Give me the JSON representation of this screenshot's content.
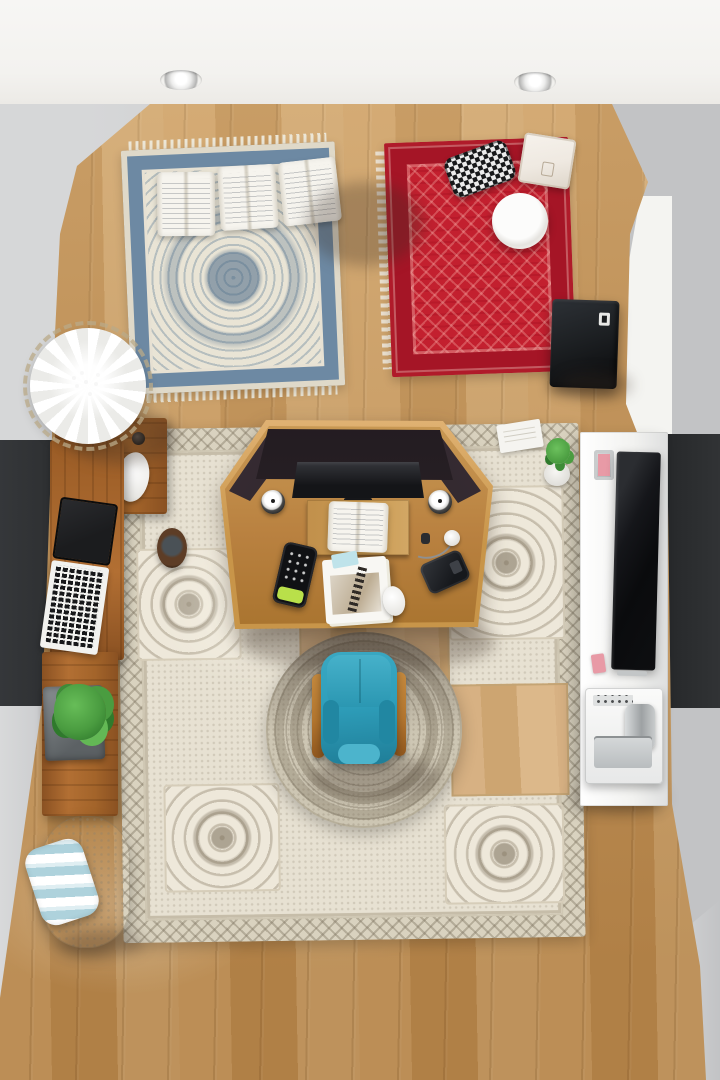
{
  "scene": {
    "view": "top-down",
    "setting": "home office room"
  },
  "palette": {
    "ceiling": "#f3f2ef",
    "wall_light": "#d6d7d8",
    "wall_mid": "#c2c3c5",
    "wall_white": "#f4f4f1",
    "wall_dark": "#2e3032",
    "wall_dark2": "#26282a",
    "floor_a": "#cb9d63",
    "floor_b": "#bd8c50",
    "rug_blue_field": "#e9e4d5",
    "rug_blue_border": "#6d89a3",
    "rug_red": "#c3202f",
    "rug_red_dark": "#a51526",
    "rug_beige": "#d9d2bf",
    "rug_beige_field": "#e7e1d2",
    "rug_round": "#cdc6b3",
    "wood_a": "#b26f33",
    "wood_b": "#8a5122",
    "desk_wood": "#b98140",
    "desk_rim": "#e0b273",
    "desk_panel": "#2c2329",
    "monitor": "#141518",
    "platform": "#c9994f",
    "page_white": "#f6f4ee",
    "chair_teal": "#2f9fbb",
    "chair_teal_dark": "#1f7e98",
    "chair_arm": "#b5772f",
    "pouf": "#d9d2c1",
    "pillow_stripe": "#aed2dc",
    "plant_green": "#4a9c40",
    "plant_green_dark": "#2f7a2c",
    "laptop_screen": "#1b1c1e",
    "laptop_deck": "#f2f2ef",
    "cube_black": "#1d2023",
    "tv_black": "#0e0f11",
    "cabinet_white": "#f2f2f0",
    "printer_silver": "#b9bdbf",
    "pink_note": "#e89aa6",
    "lamp_shade": "#b7bdb8",
    "brass": "#8c6a33",
    "umbrella_white": "#f7f6f2",
    "disc_white": "#f3f2ee",
    "box_white": "#efe9e1",
    "shadow": "rgba(60,48,38,0.30)"
  },
  "objects": {
    "room": "Top-down view of a compact home office",
    "ceiling": "White ceiling band",
    "recessed_light": "Recessed ceiling light",
    "wood_floor": "Light oak plank floor",
    "pendant_lamp": "Pendant ceiling lamp with sage shade and brass core",
    "blue_rug": "Blue-and-ivory oriental rug",
    "open_books": "Three open books on rug",
    "red_rug": "Red patterned rug with fringe",
    "knit_pillow": "Black-and-white knit bolster pillow",
    "white_box": "White gift box",
    "white_disc": "Round white tray",
    "speaker_cube": "Black speaker cube",
    "paper_umbrella": "White faceted parasol",
    "shelf_units": "Wooden wall shelf units",
    "laptop": "Open laptop with dark screen",
    "shelf_mouse": "White mouse on shelf",
    "potted_plant": "Potted green plant in gray planter",
    "pouf": "Beige knit pouf",
    "striped_pillow": "Blue-and-white striped pillow",
    "area_rug": "Large beige medallion area rug",
    "round_rug": "Round braided rug under chair",
    "coffee_cup": "Dark coffee cup on rug",
    "desk": "Wooden corner workstation with privacy panels",
    "monitor": "Widescreen monitor",
    "desk_speaker": "Small desk speaker",
    "open_book": "Open notebook on desk riser",
    "smartphone": "Smartphone with green case",
    "magazine": "Magazine and loose papers",
    "desk_mouse": "White wireless mouse",
    "wallet": "Black wallet",
    "earbuds": "Earbuds with cable",
    "office_chair": "Teal armchair with wooden arms",
    "media_cabinet": "White media cabinet",
    "tv": "Flat-screen TV on cabinet",
    "printer": "Compact printer with silver tray",
    "sticky_note": "Pink sticky note",
    "small_plant": "Small potted plant by cabinet",
    "paper_sheet": "Loose paper sheet",
    "dark_wall": "Dark charcoal accent wall section",
    "white_wall": "Bright white wall panel",
    "gray_wall": "Light gray wall"
  }
}
